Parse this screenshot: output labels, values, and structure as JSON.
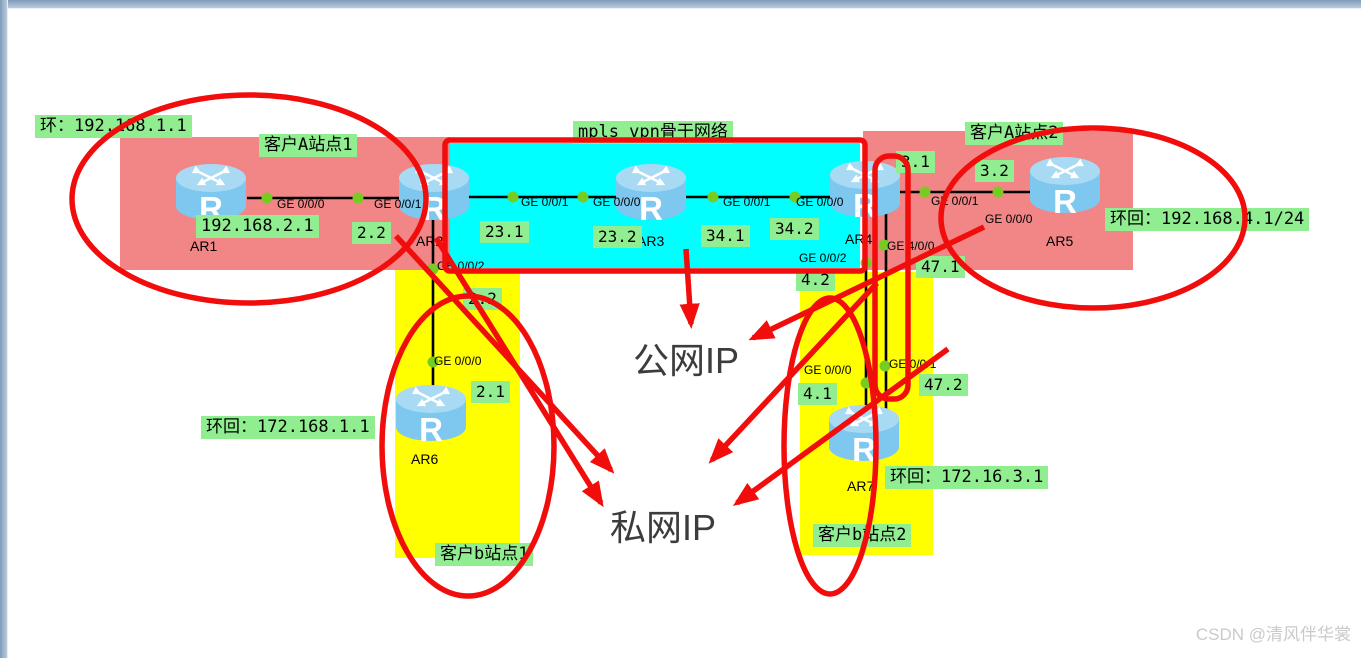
{
  "watermark": "CSDN @清风伴华裳",
  "icon_r": "R",
  "zones": {
    "backbone": {
      "label": "mpls vpn骨干网络"
    },
    "customer_a1": {
      "label": "客户A站点1"
    },
    "customer_a2": {
      "label": "客户A站点2"
    },
    "customer_b1": {
      "label": "客户b站点1"
    },
    "customer_b2": {
      "label": "客户b站点2"
    }
  },
  "routers": {
    "ar1": "AR1",
    "ar2": "AR2",
    "ar3": "AR3",
    "ar4": "AR4",
    "ar5": "AR5",
    "ar6": "AR6",
    "ar7": "AR7"
  },
  "notes": {
    "ar1_loopback": "环：192.168.1.1",
    "ar1_network": "192.168.2.1",
    "ar5_loopback": "环回：192.168.4.1/24",
    "ar6_loopback": "环回：172.168.1.1",
    "ar7_loopback": "环回：172.16.3.1",
    "public_ip": "公网IP",
    "private_ip": "私网IP"
  },
  "ip_labels": {
    "ip_2_2_top": "2.2",
    "ip_23_1": "23.1",
    "ip_23_2": "23.2",
    "ip_34_1": "34.1",
    "ip_34_2": "34.2",
    "ip_3_1": "3.1",
    "ip_3_2": "3.2",
    "ip_47_1": "47.1",
    "ip_47_2": "47.2",
    "ip_4_2": "4.2",
    "ip_4_1": "4.1",
    "ip_2_2_bottom": "2.2",
    "ip_2_1": "2.1"
  },
  "interfaces": {
    "ar1_ge000": "GE 0/0/0",
    "ar2_ge001_left": "GE 0/0/1",
    "ar2_ge001_right": "GE 0/0/1",
    "ar3_ge000": "GE 0/0/0",
    "ar3_ge001": "GE 0/0/1",
    "ar4_ge000": "GE 0/0/0",
    "ar4_ge001": "GE 0/0/1",
    "ar5_ge000": "GE 0/0/0",
    "ar2_ge002": "GE 0/0/2",
    "ar6_ge000": "GE 0/0/0",
    "ar4_ge002": "GE 0/0/2",
    "ar4_ge400": "GE 4/0/0",
    "ar7_ge000": "GE 0/0/0",
    "ar7_ge001": "GE 0/0/1"
  },
  "colors": {
    "site_fill_pink": "#f28585",
    "backbone_fill_cyan": "#00ffff",
    "site_fill_yellow": "#ffff00",
    "note_green": "#90ee90",
    "port_dot_green": "#77cc22",
    "annotation_red": "#f20d0d",
    "link_black": "#000000",
    "router_blue": "#7ec7ee"
  }
}
